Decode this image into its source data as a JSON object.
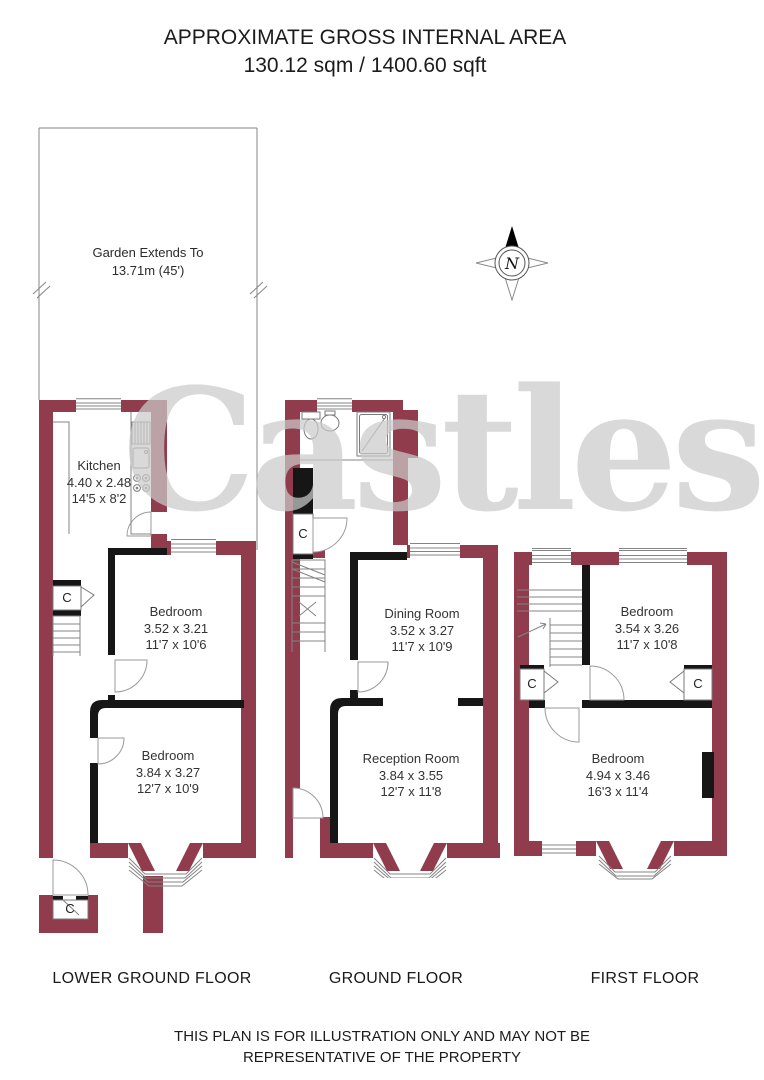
{
  "title": {
    "line1": "APPROXIMATE GROSS INTERNAL AREA",
    "line2": "130.12 sqm / 1400.60 sqft"
  },
  "garden": {
    "line1": "Garden Extends To",
    "line2": "13.71m (45')"
  },
  "compass": {
    "label": "N"
  },
  "watermark": "Castles",
  "floors": [
    {
      "id": "lower-ground-floor",
      "label": "LOWER GROUND FLOOR",
      "rooms": [
        {
          "name": "Kitchen",
          "metric": "4.40 x 2.48",
          "imperial": "14'5 x 8'2"
        },
        {
          "name": "Bedroom",
          "metric": "3.52 x 3.21",
          "imperial": "11'7 x 10'6"
        },
        {
          "name": "Bedroom",
          "metric": "3.84 x 3.27",
          "imperial": "12'7 x 10'9"
        }
      ],
      "closets": [
        "C",
        "C"
      ]
    },
    {
      "id": "ground-floor",
      "label": "GROUND FLOOR",
      "rooms": [
        {
          "name": "Dining Room",
          "metric": "3.52 x 3.27",
          "imperial": "11'7 x 10'9"
        },
        {
          "name": "Reception Room",
          "metric": "3.84 x 3.55",
          "imperial": "12'7 x 11'8"
        }
      ],
      "closets": [
        "C"
      ]
    },
    {
      "id": "first-floor",
      "label": "FIRST FLOOR",
      "rooms": [
        {
          "name": "Bedroom",
          "metric": "3.54 x 3.26",
          "imperial": "11'7 x 10'8"
        },
        {
          "name": "Bedroom",
          "metric": "4.94 x 3.46",
          "imperial": "16'3 x 11'4"
        }
      ],
      "closets": [
        "C",
        "C"
      ]
    }
  ],
  "disclaimer": {
    "line1": "THIS PLAN IS FOR ILLUSTRATION ONLY AND MAY NOT BE",
    "line2": "REPRESENTATIVE OF THE PROPERTY"
  },
  "colors": {
    "wall": "#903C4C",
    "interior_wall": "#161616",
    "thin_line": "#848484",
    "text": "#222222",
    "watermark": "#cbcbcb"
  }
}
